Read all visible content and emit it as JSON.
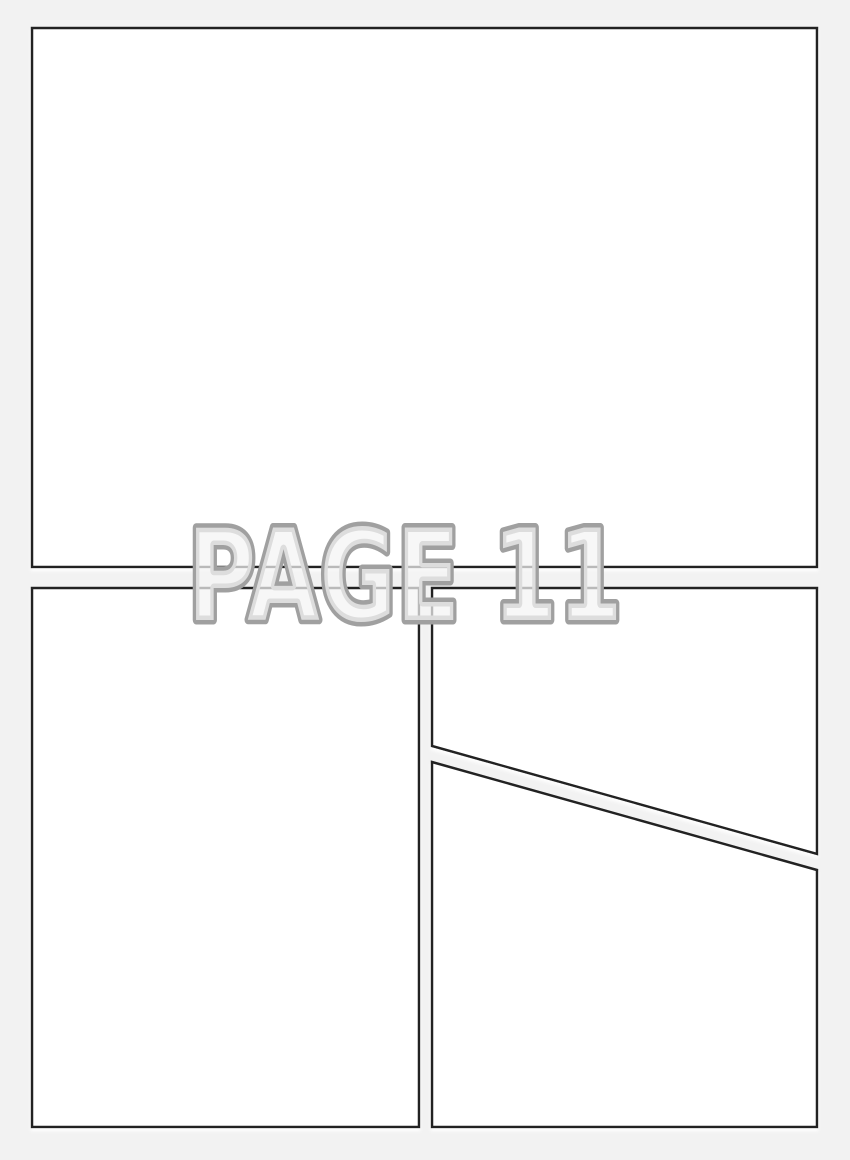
{
  "page": {
    "label": "PAGE 11"
  },
  "colors": {
    "background": "#f2f2f2",
    "panel_fill": "#ffffff",
    "panel_border": "#222222",
    "gutter": "#f2f2f2",
    "label_fill": "#f4f4f4",
    "label_stroke": "#a0a0a0"
  },
  "panels": [
    {
      "id": "panel-1",
      "position": "top",
      "shape": "rectangle"
    },
    {
      "id": "panel-2",
      "position": "bottom-left",
      "shape": "rectangle"
    },
    {
      "id": "panel-3",
      "position": "middle-right",
      "shape": "quadrilateral-diagonal-bottom"
    },
    {
      "id": "panel-4",
      "position": "bottom-right",
      "shape": "quadrilateral-diagonal-top"
    }
  ]
}
